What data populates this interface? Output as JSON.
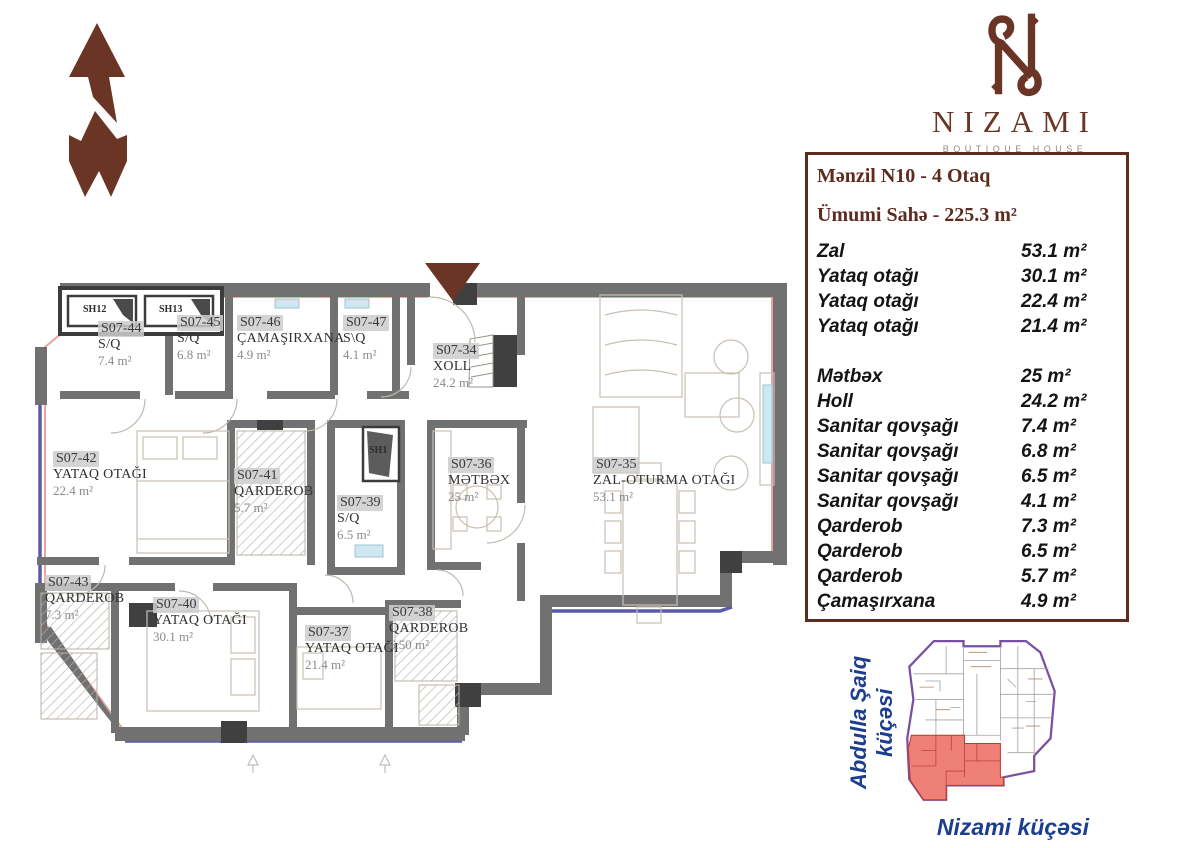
{
  "logo": {
    "name": "NIZAMI",
    "subtitle": "BOUTIQUE HOUSE"
  },
  "info_panel": {
    "title": "Mənzil N10 - 4 Otaq",
    "total_area": "Ümumi Sahə - 225.3 m²",
    "rows": [
      {
        "label": "Zal",
        "area": "53.1 m²"
      },
      {
        "label": "Yataq otağı",
        "area": "30.1 m²"
      },
      {
        "label": "Yataq otağı",
        "area": "22.4 m²"
      },
      {
        "label": "Yataq otağı",
        "area": "21.4 m²"
      },
      {
        "label": "Mətbəx",
        "area": "25 m²"
      },
      {
        "label": "Holl",
        "area": "24.2 m²"
      },
      {
        "label": "Sanitar qovşağı",
        "area": "7.4 m²"
      },
      {
        "label": "Sanitar qovşağı",
        "area": "6.8 m²"
      },
      {
        "label": "Sanitar qovşağı",
        "area": "6.5 m²"
      },
      {
        "label": "Sanitar qovşağı",
        "area": "4.1 m²"
      },
      {
        "label": "Qarderob",
        "area": "7.3 m²"
      },
      {
        "label": "Qarderob",
        "area": "6.5 m²"
      },
      {
        "label": "Qarderob",
        "area": "5.7 m²"
      },
      {
        "label": "Çamaşırxana",
        "area": "4.9 m²"
      }
    ]
  },
  "floor_plan": {
    "rooms": [
      {
        "code": "S07-44",
        "name": "S/Q",
        "area": "7.4 m²"
      },
      {
        "code": "S07-45",
        "name": "S/Q",
        "area": "6.8 m²"
      },
      {
        "code": "S07-46",
        "name": "ÇAMAŞIRXANA",
        "area": "4.9 m²"
      },
      {
        "code": "S07-47",
        "name": "S\\Q",
        "area": "4.1 m²"
      },
      {
        "code": "S07-34",
        "name": "XOLL",
        "area": "24.2 m²"
      },
      {
        "code": "S07-35",
        "name": "ZAL-OTURMA OTAĞI",
        "area": "53.1 m²"
      },
      {
        "code": "S07-36",
        "name": "MƏTBƏX",
        "area": "25 m²"
      },
      {
        "code": "S07-39",
        "name": "S/Q",
        "area": "6.5 m²"
      },
      {
        "code": "S07-41",
        "name": "QARDEROB",
        "area": "5.7 m²"
      },
      {
        "code": "S07-42",
        "name": "YATAQ OTAĞI",
        "area": "22.4 m²"
      },
      {
        "code": "S07-43",
        "name": "QARDEROB",
        "area": "7.3 m²"
      },
      {
        "code": "S07-40",
        "name": "YATAQ OTAĞI",
        "area": "30.1 m²"
      },
      {
        "code": "S07-37",
        "name": "YATAQ OTAĞI",
        "area": "21.4 m²"
      },
      {
        "code": "S07-38",
        "name": "QARDEROB",
        "area": "6.50 m²"
      }
    ],
    "shafts": {
      "sh12": "SH12",
      "sh13": "SH13",
      "sh1": "SH1"
    }
  },
  "site_map": {
    "street_left": "Abdulla Şaiq küçəsi",
    "street_bottom": "Nizami küçəsi"
  },
  "colors": {
    "brand_brown": "#6b3526",
    "panel_border": "#5e2c1e",
    "street_navy": "#1c3d90",
    "wall_gray": "#717171",
    "balcony_blue": "#5b5baa",
    "exterior_pink": "#eba49d",
    "highlight_red": "#ef8078",
    "sitemap_purple": "#7a4fa3"
  }
}
